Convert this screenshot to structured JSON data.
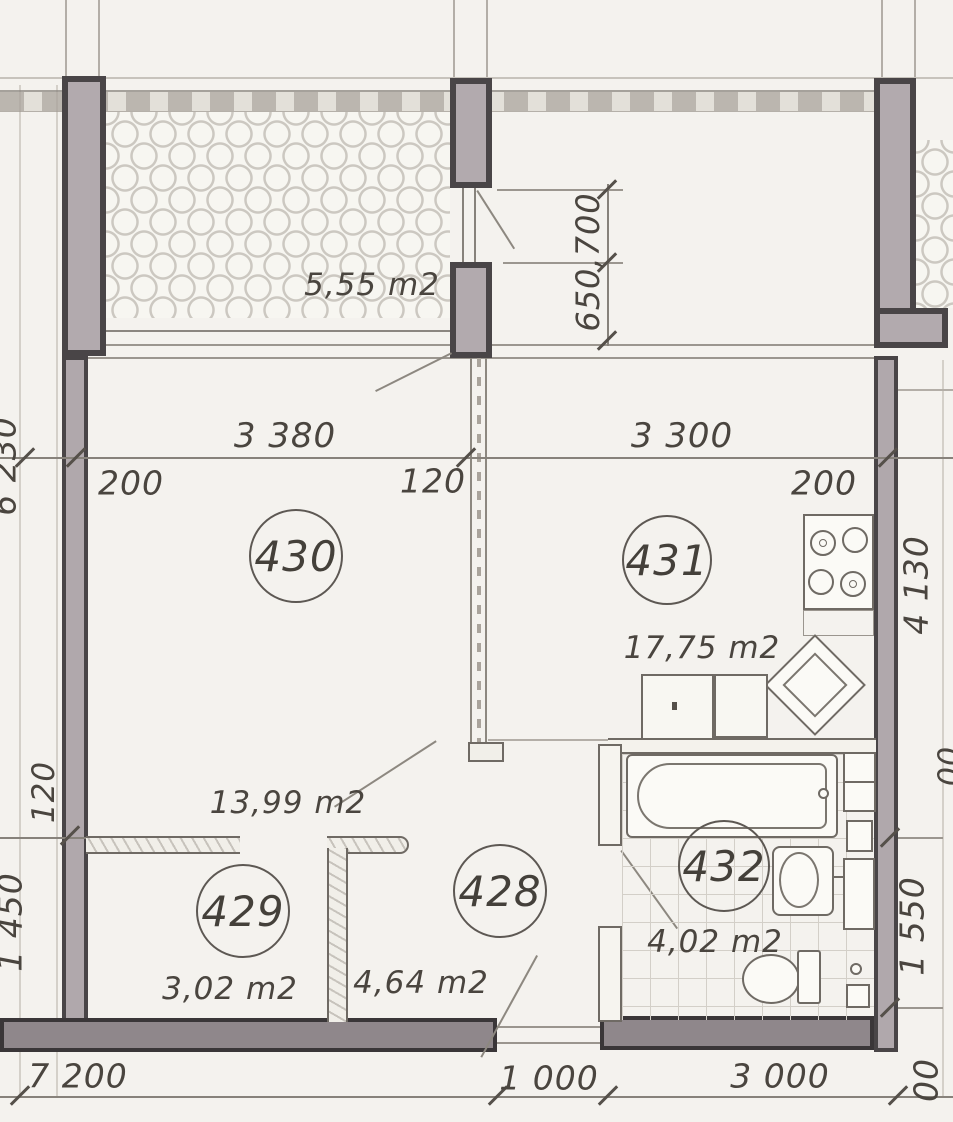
{
  "plan_title": "apartment floor plan",
  "balcony": {
    "area_label": "5,55 m2"
  },
  "rooms": [
    {
      "number": "430",
      "area_label": "13,99 m2"
    },
    {
      "number": "431",
      "area_label": "17,75 m2"
    },
    {
      "number": "429",
      "area_label": "3,02 m2"
    },
    {
      "number": "428",
      "area_label": "4,64 m2"
    },
    {
      "number": "432",
      "area_label": "4,02 m2"
    }
  ],
  "dimensions": {
    "top": {
      "room_left_width": "3 380",
      "room_right_width": "3 300",
      "wall_left": "200",
      "partition_mid": "120",
      "wall_right": "200"
    },
    "window_stack": "650,700",
    "left": {
      "upper_partial": "6 230",
      "partition": "120",
      "lower": "1 450"
    },
    "right": {
      "upper": "4 130",
      "lower": "1 550",
      "mid_partial": "00"
    },
    "bottom": {
      "left_total": "7 200",
      "door_opening": "1 000",
      "bath_width": "3 000",
      "edge_partial": "00"
    }
  }
}
